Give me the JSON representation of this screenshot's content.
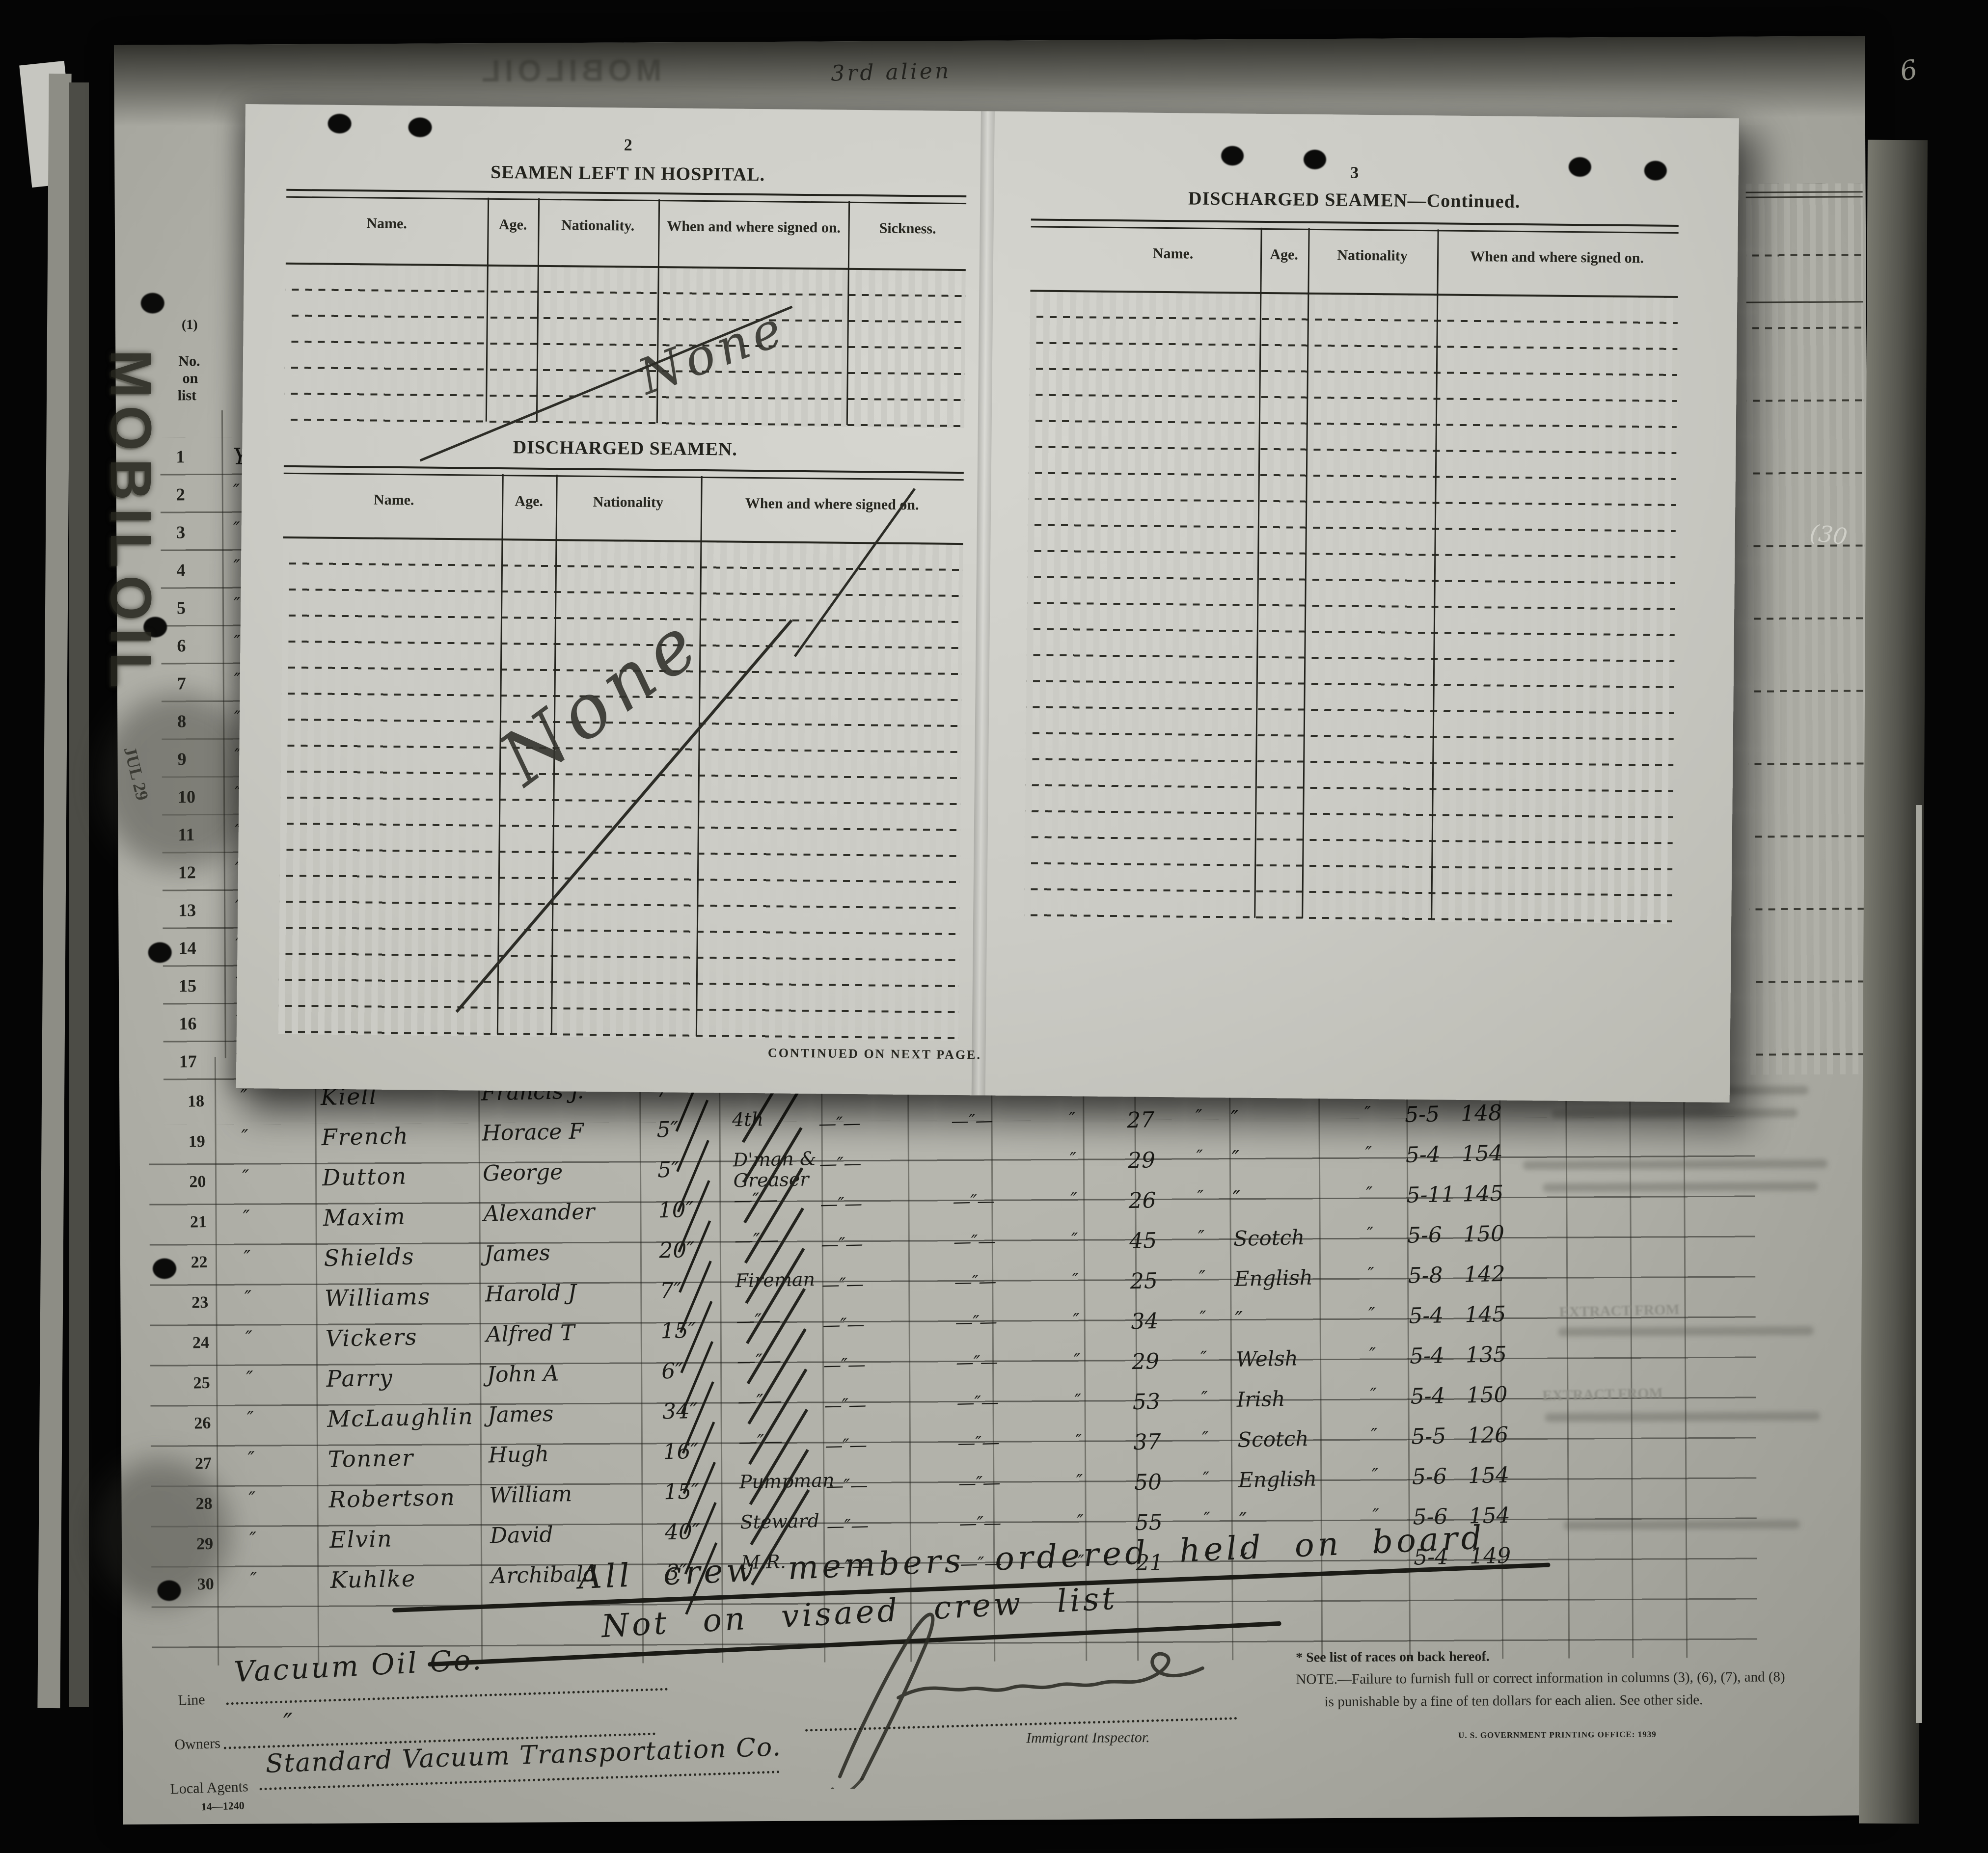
{
  "overlay": {
    "page2": {
      "number": "2",
      "hospital_title": "SEAMEN LEFT IN HOSPITAL.",
      "hospital_columns": [
        "Name.",
        "Age.",
        "Nationality.",
        "When and where signed on.",
        "Sickness."
      ],
      "hospital_entry": "None",
      "discharged_title": "DISCHARGED SEAMEN.",
      "discharged_columns": [
        "Name.",
        "Age.",
        "Nationality",
        "When and where signed on."
      ],
      "discharged_entry": "None",
      "continued": "CONTINUED ON NEXT PAGE."
    },
    "page3": {
      "number": "3",
      "title": "DISCHARGED SEAMEN—Continued.",
      "columns": [
        "Name.",
        "Age.",
        "Nationality",
        "When and where signed on."
      ]
    }
  },
  "sheet": {
    "form_no": "Form 680",
    "dept": "U. S. DEPARTMENT OF",
    "service": "IMMIGRATION SE",
    "required": "Required un",
    "col1_no": "(1)",
    "col1_line1": "No.",
    "col1_line2": "on",
    "col1_line3": "list",
    "col2_no": "(2)",
    "col2_line1": "State w",
    "col2_line2": "member",
    "col2_line3": "last pre",
    "col2_line4": "voyage of",
    "col2_line5": "U.",
    "top_scrawl": "3rd alien",
    "rows_upper": [
      {
        "no": "1",
        "mark": "Ye"
      },
      {
        "no": "2",
        "mark": "″"
      },
      {
        "no": "3",
        "mark": "″"
      },
      {
        "no": "4",
        "mark": "″"
      },
      {
        "no": "5",
        "mark": "″"
      },
      {
        "no": "6",
        "mark": "″"
      },
      {
        "no": "7",
        "mark": "″"
      },
      {
        "no": "8",
        "mark": "″"
      },
      {
        "no": "9",
        "mark": "″"
      },
      {
        "no": "10",
        "mark": "″"
      },
      {
        "no": "11",
        "mark": "″"
      },
      {
        "no": "12",
        "mark": "″"
      },
      {
        "no": "13",
        "mark": "″"
      },
      {
        "no": "14",
        "mark": "″"
      },
      {
        "no": "15",
        "mark": "″"
      },
      {
        "no": "16",
        "mark": "″"
      },
      {
        "no": "17",
        "mark": "″"
      }
    ],
    "rows": [
      {
        "no": "18",
        "d": "″",
        "surname": "Kiell",
        "given": "Francis J.",
        "years": "7″",
        "r": "3rd",
        "r2": "",
        "d1": "—″—",
        "d2": "—″—",
        "m1": "″",
        "age": "29",
        "m2": "″",
        "nat": "″",
        "m3": "″",
        "date": "5-4",
        "num": "140"
      },
      {
        "no": "19",
        "d": "″",
        "surname": "French",
        "given": "Horace F",
        "years": "5″",
        "r": "4th",
        "r2": "",
        "d1": "—″—",
        "d2": "—″—",
        "m1": "″",
        "age": "27",
        "m2": "″",
        "nat": "″",
        "m3": "″",
        "date": "5-5",
        "num": "148"
      },
      {
        "no": "20",
        "d": "″",
        "surname": "Dutton",
        "given": "George",
        "years": "5″",
        "r": "D'man &",
        "r2": "Greaser",
        "d1": "—″—",
        "d2": "",
        "m1": "″",
        "age": "29",
        "m2": "″",
        "nat": "″",
        "m3": "″",
        "date": "5-4",
        "num": "154"
      },
      {
        "no": "21",
        "d": "″",
        "surname": "Maxim",
        "given": "Alexander",
        "years": "10″",
        "r": "—″—",
        "r2": "",
        "d1": "—″—",
        "d2": "—″—",
        "m1": "″",
        "age": "26",
        "m2": "″",
        "nat": "″",
        "m3": "″",
        "date": "5-11",
        "num": "145"
      },
      {
        "no": "22",
        "d": "″",
        "surname": "Shields",
        "given": "James",
        "years": "20″",
        "r": "—″—",
        "r2": "",
        "d1": "—″—",
        "d2": "—″—",
        "m1": "″",
        "age": "45",
        "m2": "″",
        "nat": "Scotch",
        "m3": "″",
        "date": "5-6",
        "num": "150"
      },
      {
        "no": "23",
        "d": "″",
        "surname": "Williams",
        "given": "Harold J",
        "years": "7″",
        "r": "Fireman",
        "r2": "",
        "d1": "—″—",
        "d2": "—″—",
        "m1": "″",
        "age": "25",
        "m2": "″",
        "nat": "English",
        "m3": "″",
        "date": "5-8",
        "num": "142"
      },
      {
        "no": "24",
        "d": "″",
        "surname": "Vickers",
        "given": "Alfred T",
        "years": "15″",
        "r": "—″—",
        "r2": "",
        "d1": "—″—",
        "d2": "—″—",
        "m1": "″",
        "age": "34",
        "m2": "″",
        "nat": "″",
        "m3": "″",
        "date": "5-4",
        "num": "145"
      },
      {
        "no": "25",
        "d": "″",
        "surname": "Parry",
        "given": "John A",
        "years": "6″",
        "r": "—″—",
        "r2": "",
        "d1": "—″—",
        "d2": "—″—",
        "m1": "″",
        "age": "29",
        "m2": "″",
        "nat": "Welsh",
        "m3": "″",
        "date": "5-4",
        "num": "135"
      },
      {
        "no": "26",
        "d": "″",
        "surname": "McLaughlin",
        "given": "James",
        "years": "34″",
        "r": "—″—",
        "r2": "",
        "d1": "—″—",
        "d2": "—″—",
        "m1": "″",
        "age": "53",
        "m2": "″",
        "nat": "Irish",
        "m3": "″",
        "date": "5-4",
        "num": "150"
      },
      {
        "no": "27",
        "d": "″",
        "surname": "Tonner",
        "given": "Hugh",
        "years": "16″",
        "r": "—″—",
        "r2": "",
        "d1": "—″—",
        "d2": "—″—",
        "m1": "″",
        "age": "37",
        "m2": "″",
        "nat": "Scotch",
        "m3": "″",
        "date": "5-5",
        "num": "126"
      },
      {
        "no": "28",
        "d": "″",
        "surname": "Robertson",
        "given": "William",
        "years": "15″",
        "r": "Pumpman",
        "r2": "",
        "d1": "—″—",
        "d2": "—″—",
        "m1": "″",
        "age": "50",
        "m2": "″",
        "nat": "English",
        "m3": "″",
        "date": "5-6",
        "num": "154"
      },
      {
        "no": "29",
        "d": "″",
        "surname": "Elvin",
        "given": "David",
        "years": "40″",
        "r": "Steward",
        "r2": "",
        "d1": "—″—",
        "d2": "—″—",
        "m1": "″",
        "age": "55",
        "m2": "″",
        "nat": "″",
        "m3": "″",
        "date": "5-6",
        "num": "154"
      },
      {
        "no": "30",
        "d": "″",
        "surname": "Kuhlke",
        "given": "Archibald",
        "years": "3″",
        "r": "M.R.",
        "r2": "",
        "d1": "—″—",
        "d2": "—″—",
        "m1": "″",
        "age": "21",
        "m2": "″",
        "nat": "″",
        "m3": "″",
        "date": "5-4",
        "num": "149"
      }
    ],
    "note_held": "All crew members ordered held on board",
    "note_visaed": "Not on visaed crew list"
  },
  "footer": {
    "line_label": "Line",
    "line_value": "Vacuum Oil Co.",
    "owners_label": "Owners",
    "owners_value": "″",
    "agents_label": "Local Agents",
    "agents_value": "Standard Vacuum Transportation Co.",
    "form_code": "14—1240",
    "inspector_label": "Immigrant Inspector.",
    "races_note": "* See list of races on back hereof.",
    "note_line1": "NOTE.—Failure to furnish full or correct information in columns (3), (6), (7), and (8)",
    "note_line2": "is punishable by a fine of ten dollars for each alien.   See other side.",
    "printing_office": "U. S. GOVERNMENT PRINTING OFFICE: 1939"
  },
  "marks": {
    "mobiloil": "MOBILOIL",
    "date_stamp": "JUL 29",
    "corner_six": "6",
    "edge_thirty": "(30",
    "extract1": "EXTRACT FROM",
    "extract2": "EXTRACT FROM"
  }
}
